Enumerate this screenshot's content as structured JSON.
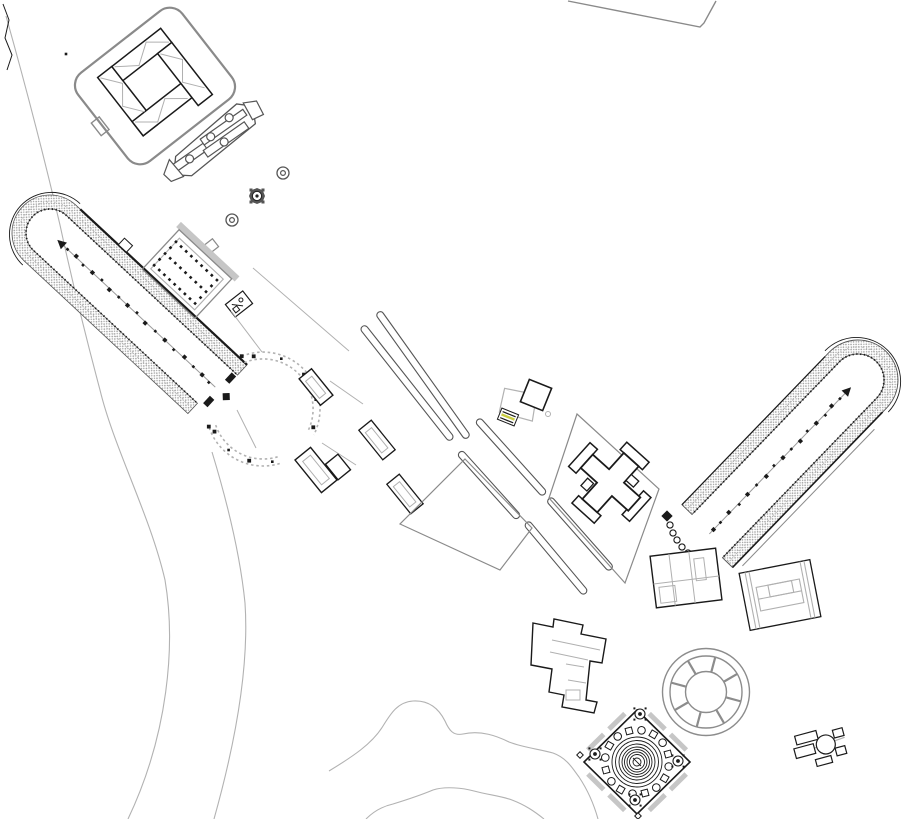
{
  "colors": {
    "background": "#ffffff",
    "ink": "#1a1a1a",
    "ruin_gray": "#555555",
    "terrain_gray": "#b2b2b2",
    "parcel_gray": "#8a8a8a",
    "detail_gray": "#b0b0b0",
    "stands_gray": "#9b9b9b",
    "wall_gray": "#c6c6c6",
    "wheel_gray": "#8c8c8c",
    "accent_yellow": "#c9cd42"
  },
  "features": [
    {
      "id": "terrain-contours",
      "label": "terrain contour lines"
    },
    {
      "id": "parcel-boundary-ne",
      "label": "north-east parcel boundary"
    },
    {
      "id": "walled-enclosure",
      "label": "walled enclosure with inner halls"
    },
    {
      "id": "collapsed-colonnade",
      "label": "collapsed colonnade ruin"
    },
    {
      "id": "round-monument-a",
      "label": "small round monument"
    },
    {
      "id": "round-monument-b",
      "label": "small round monument"
    },
    {
      "id": "octagonal-monument",
      "label": "octagonal monument"
    },
    {
      "id": "small-square-structure",
      "label": "small square structure"
    },
    {
      "id": "west-stadium",
      "label": "west stadium with spectator banks"
    },
    {
      "id": "colonnaded-court",
      "label": "colonnaded court with column grid"
    },
    {
      "id": "annex-building",
      "label": "small annex building"
    },
    {
      "id": "circular-plaza",
      "label": "circular colonnaded plaza"
    },
    {
      "id": "plaza-building-north",
      "label": "building inside plaza"
    },
    {
      "id": "plaza-buildings-south",
      "label": "buildings south of plaza"
    },
    {
      "id": "road-strips",
      "label": "long wall / road strips"
    },
    {
      "id": "freestanding-buildings",
      "label": "free-standing rectangular buildings"
    },
    {
      "id": "gate-monument",
      "label": "gate monument with marked block"
    },
    {
      "id": "field-parcel-west",
      "label": "west field parcel"
    },
    {
      "id": "field-parcel-east",
      "label": "east field parcel"
    },
    {
      "id": "cruciform-building",
      "label": "cruciform building"
    },
    {
      "id": "east-stadium",
      "label": "east stadium with spectator banks"
    },
    {
      "id": "stadium-gate-chain",
      "label": "curved gate colonnade of east stadium"
    },
    {
      "id": "south-annex-building",
      "label": "annex building at stadium end"
    },
    {
      "id": "hall-building",
      "label": "rectangular hall building"
    },
    {
      "id": "segmented-rotunda",
      "label": "segmented round building"
    },
    {
      "id": "circular-monument",
      "label": "circular monument with column ring"
    },
    {
      "id": "l-shaped-building",
      "label": "L-shaped building complex"
    },
    {
      "id": "small-bath-cluster",
      "label": "small building cluster with round room"
    },
    {
      "id": "hill-contours-south",
      "label": "southern hill contour"
    }
  ]
}
